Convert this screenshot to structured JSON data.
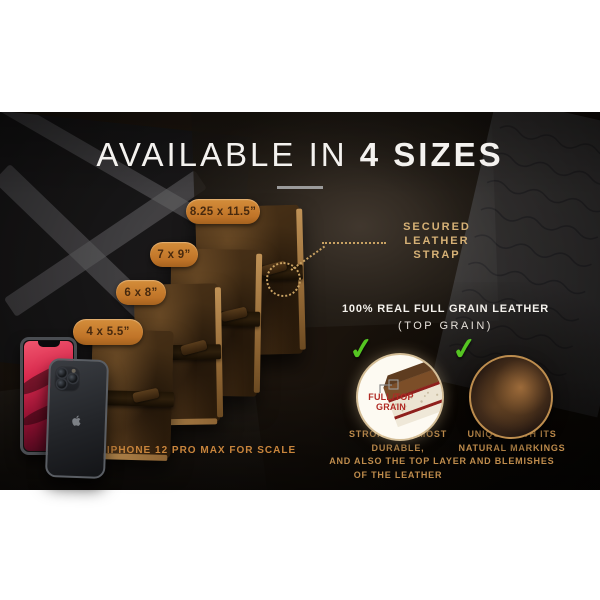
{
  "hero": {
    "title_light": "AVAILABLE IN",
    "title_bold": "4 SIZES"
  },
  "size_badges": [
    {
      "label": "8.25 x 11.5”"
    },
    {
      "label": "7 x 9”"
    },
    {
      "label": "6 x 8”"
    },
    {
      "label": "4 x 5.5”"
    }
  ],
  "strap_callout": {
    "text": "SECURED\nLEATHER STRAP"
  },
  "leather": {
    "heading": "100% REAL FULL GRAIN LEATHER",
    "subheading": "(TOP GRAIN)",
    "check_icon": "✓",
    "left": {
      "diagram_label": "FULL/TOP\nGRAIN",
      "caption": "STRONGEST, MOST DURABLE,\nAND ALSO THE TOP LAYER\nOF THE LEATHER"
    },
    "right": {
      "caption": "UNIQUE WITH ITS\nNATURAL MARKINGS\nAND BLEMISHES"
    }
  },
  "scale_note": "*IPHONE 12 PRO MAX FOR SCALE",
  "colors": {
    "badge_orange": "#c67c2d",
    "badge_text": "#47290e",
    "accent_tan": "#d6b176",
    "caption_tan": "#bf8c4c",
    "check_green": "#55c522",
    "title_white": "#f4f2ef",
    "diagram_red": "#b02a24",
    "background_dark": "#17100a"
  }
}
